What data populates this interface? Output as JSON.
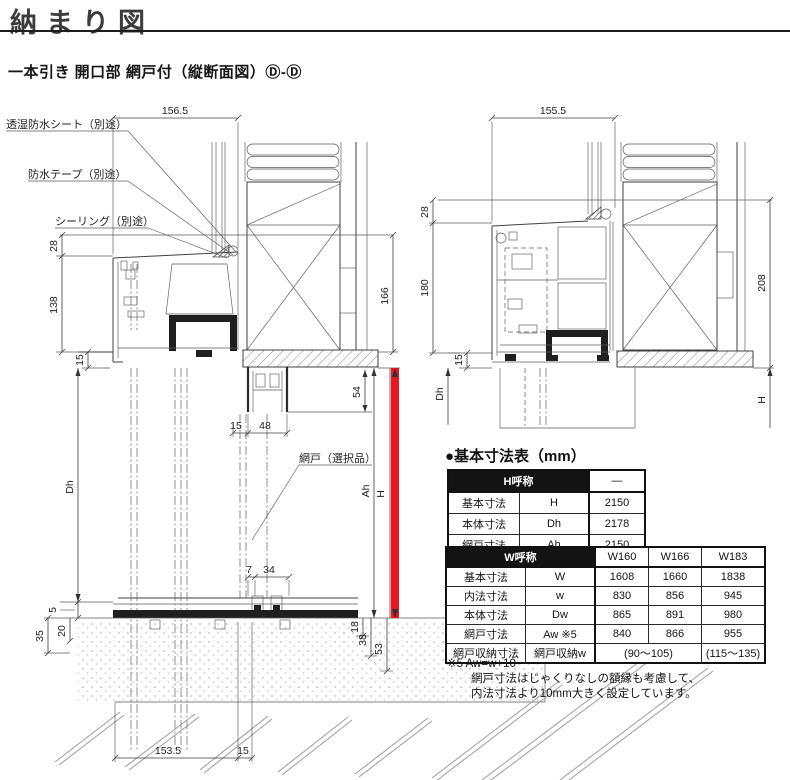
{
  "header": {
    "title": "納まり図",
    "subtitle": "一本引き 開口部 網戸付（縦断面図）Ⓓ-Ⓓ"
  },
  "left_drawing": {
    "callouts": {
      "sheet": "透湿防水シート（別途）",
      "tape": "防水テープ（別途）",
      "sealing": "シーリング（別途）",
      "screen": "網戸（選択品）"
    },
    "dims": {
      "top_width": "156.5",
      "h28": "28",
      "h138": "138",
      "h15": "15",
      "dh": "Dh",
      "d5": "5",
      "d20": "20",
      "d35": "35",
      "v166": "166",
      "d54": "54",
      "p15": "15",
      "p48": "48",
      "d7": "7",
      "d34": "34",
      "ah": "Ah",
      "h": "H",
      "d18": "18",
      "d38": "38",
      "d53": "53",
      "bottom_main": "153.5",
      "bottom_sub": "15"
    }
  },
  "right_drawing": {
    "dims": {
      "top_width": "155.5",
      "h28": "28",
      "h180": "180",
      "h15": "15",
      "dh": "Dh",
      "v208": "208",
      "h": "H"
    }
  },
  "spec": {
    "section_title": "●基本寸法表（mm）",
    "h_table": {
      "header_label": "H呼称",
      "header_value": "—",
      "rows": [
        [
          "基本寸法",
          "H",
          "2150"
        ],
        [
          "本体寸法",
          "Dh",
          "2178"
        ],
        [
          "網戸寸法",
          "Ah",
          "2150"
        ]
      ]
    },
    "w_table": {
      "header_label": "W呼称",
      "columns": [
        "W160",
        "W166",
        "W183"
      ],
      "rows": [
        [
          "基本寸法",
          "W",
          "1608",
          "1660",
          "1838"
        ],
        [
          "内法寸法",
          "w",
          "830",
          "856",
          "945"
        ],
        [
          "本体寸法",
          "Dw",
          "865",
          "891",
          "980"
        ],
        [
          "網戸寸法",
          "Aw ※5",
          "840",
          "866",
          "955"
        ]
      ],
      "storage_row": {
        "label": "網戸収納寸法",
        "code": "網戸収納w",
        "w160_166": "(90～105)",
        "w183": "(115～135)"
      }
    },
    "footnote": {
      "line1": "※5 Aw=w+10",
      "line2": "網戸寸法はじゃくりなしの額縁も考慮して、",
      "line3": "内法寸法より10mm大きく設定しています。"
    }
  },
  "colors": {
    "accent_red": "#e8141e",
    "table_header_bg": "#131313",
    "line": "#3f3f3f"
  }
}
